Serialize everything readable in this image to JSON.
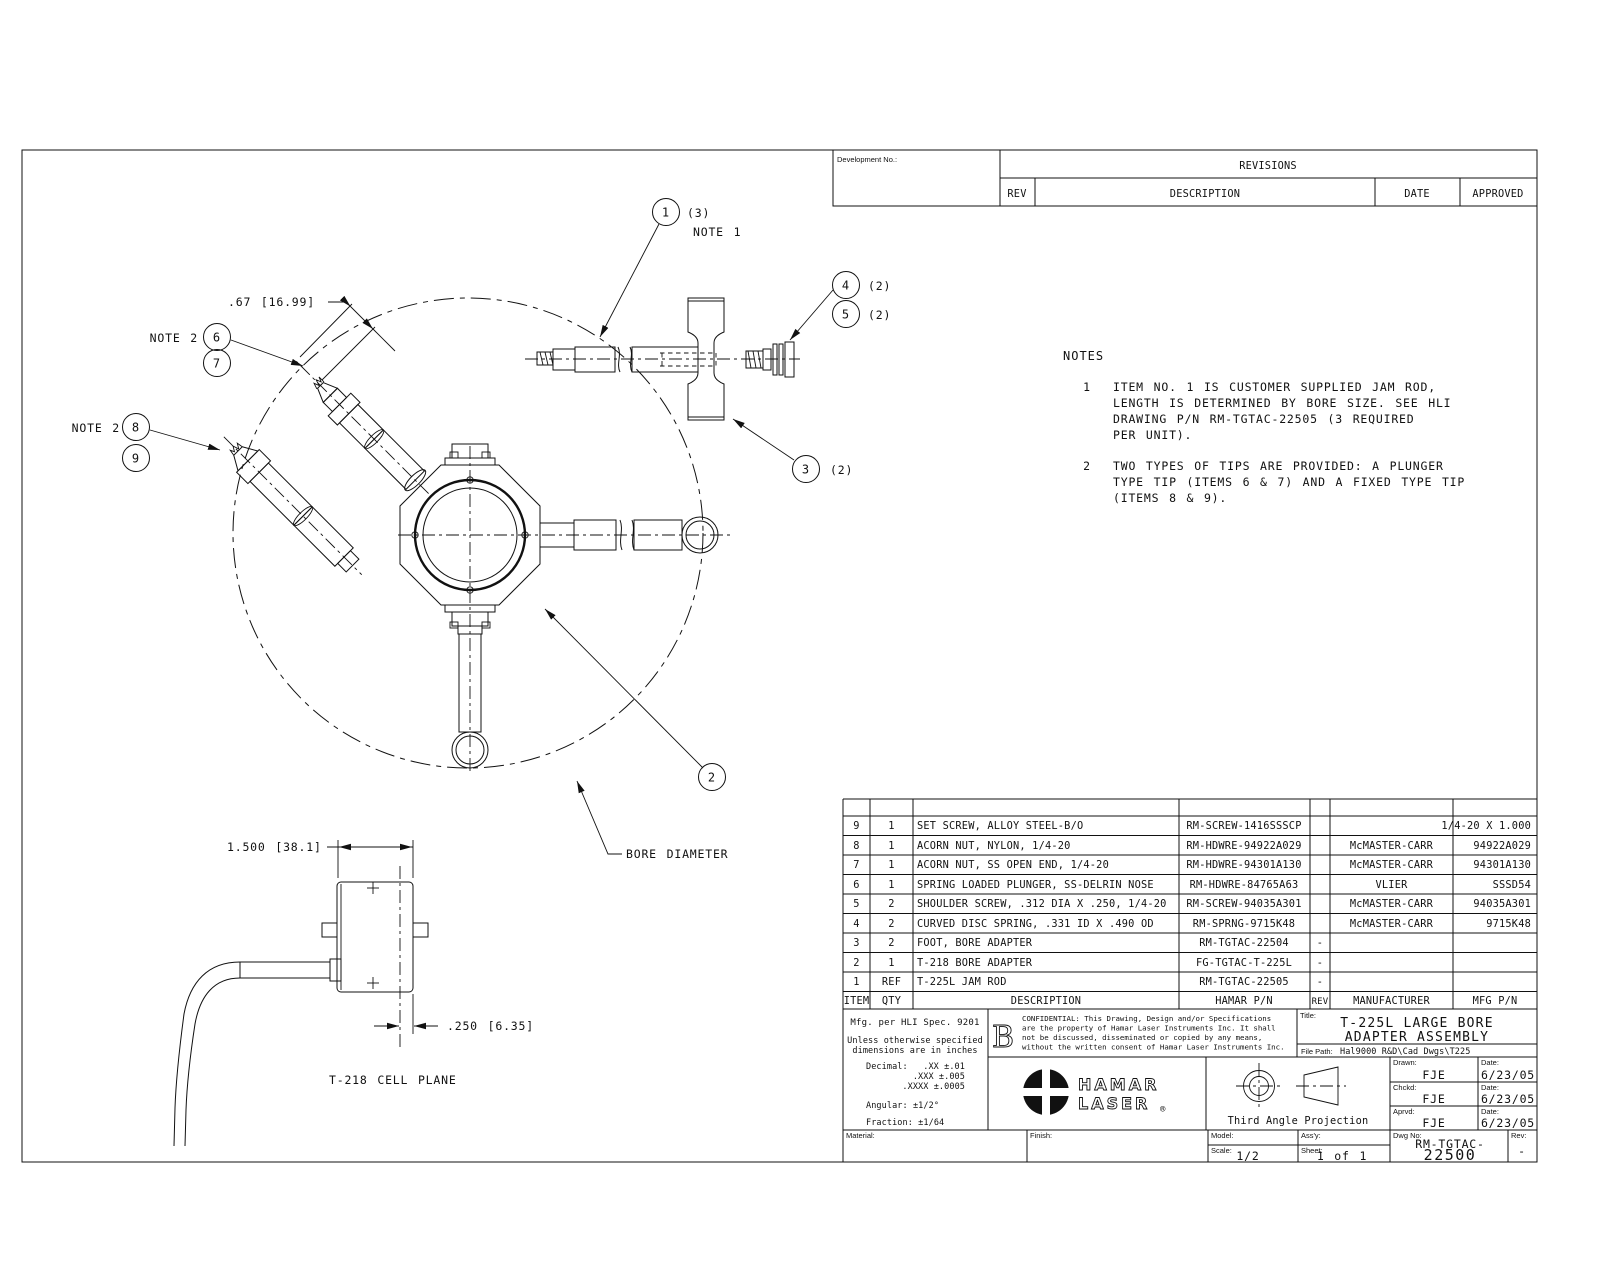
{
  "revisions": {
    "development_label": "Development No.:",
    "title": "REVISIONS",
    "col_rev": "REV",
    "col_description": "DESCRIPTION",
    "col_date": "DATE",
    "col_approved": "APPROVED"
  },
  "notes": {
    "title": "NOTES",
    "note1_num": "1",
    "note1_line1": "ITEM NO. 1 IS CUSTOMER SUPPLIED JAM ROD,",
    "note1_line2": "LENGTH IS DETERMINED BY BORE SIZE. SEE HLI",
    "note1_line3": "DRAWING P/N RM-TGTAC-22505 (3 REQUIRED",
    "note1_line4": "PER UNIT).",
    "note2_num": "2",
    "note2_line1": "TWO TYPES OF TIPS ARE PROVIDED: A PLUNGER",
    "note2_line2": "TYPE TIP (ITEMS 6 & 7) AND A FIXED TYPE TIP",
    "note2_line3": "(ITEMS 8 & 9)."
  },
  "callouts": {
    "b1": "1",
    "b1_qty": "(3)",
    "b1_note": "NOTE 1",
    "b2": "2",
    "b3": "3",
    "b3_qty": "(2)",
    "b4": "4",
    "b4_qty": "(2)",
    "b5": "5",
    "b5_qty": "(2)",
    "b6": "6",
    "b7": "7",
    "note2_ref_a": "NOTE 2",
    "b8": "8",
    "b9": "9",
    "note2_ref_b": "NOTE 2",
    "dim_tip": ".67 [16.99]",
    "bore_diameter": "BORE DIAMETER",
    "dim_width": "1.500 [38.1]",
    "dim_offset": ".250 [6.35]",
    "cell_plane": "T-218 CELL PLANE"
  },
  "bom": {
    "header": {
      "item": "ITEM",
      "qty": "QTY",
      "description": "DESCRIPTION",
      "hamar_pn": "HAMAR P/N",
      "rev": "REV",
      "manufacturer": "MANUFACTURER",
      "mfg_pn": "MFG P/N"
    },
    "rows": [
      {
        "item": "9",
        "qty": "1",
        "description": "SET SCREW, ALLOY STEEL-B/O",
        "hamar_pn": "RM-SCREW-1416SSSCP",
        "rev": "",
        "manufacturer": "",
        "mfg_pn": "1/4-20 X 1.000"
      },
      {
        "item": "8",
        "qty": "1",
        "description": "ACORN NUT, NYLON, 1/4-20",
        "hamar_pn": "RM-HDWRE-94922A029",
        "rev": "",
        "manufacturer": "McMASTER-CARR",
        "mfg_pn": "94922A029"
      },
      {
        "item": "7",
        "qty": "1",
        "description": "ACORN NUT, SS OPEN END, 1/4-20",
        "hamar_pn": "RM-HDWRE-94301A130",
        "rev": "",
        "manufacturer": "McMASTER-CARR",
        "mfg_pn": "94301A130"
      },
      {
        "item": "6",
        "qty": "1",
        "description": "SPRING LOADED PLUNGER, SS-DELRIN NOSE",
        "hamar_pn": "RM-HDWRE-84765A63",
        "rev": "",
        "manufacturer": "VLIER",
        "mfg_pn": "SSSD54"
      },
      {
        "item": "5",
        "qty": "2",
        "description": "SHOULDER SCREW, .312 DIA X .250, 1/4-20",
        "hamar_pn": "RM-SCREW-94035A301",
        "rev": "",
        "manufacturer": "McMASTER-CARR",
        "mfg_pn": "94035A301"
      },
      {
        "item": "4",
        "qty": "2",
        "description": "CURVED DISC SPRING, .331 ID X .490 OD",
        "hamar_pn": "RM-SPRNG-9715K48",
        "rev": "",
        "manufacturer": "McMASTER-CARR",
        "mfg_pn": "9715K48"
      },
      {
        "item": "3",
        "qty": "2",
        "description": "FOOT, BORE ADAPTER",
        "hamar_pn": "RM-TGTAC-22504",
        "rev": "-",
        "manufacturer": "",
        "mfg_pn": ""
      },
      {
        "item": "2",
        "qty": "1",
        "description": "T-218 BORE ADAPTER",
        "hamar_pn": "FG-TGTAC-T-225L",
        "rev": "-",
        "manufacturer": "",
        "mfg_pn": ""
      },
      {
        "item": "1",
        "qty": "REF",
        "description": "T-225L JAM ROD",
        "hamar_pn": "RM-TGTAC-22505",
        "rev": "-",
        "manufacturer": "",
        "mfg_pn": ""
      }
    ]
  },
  "title_block": {
    "mfg_spec": "Mfg. per HLI Spec. 9201",
    "tol_line1": "Unless otherwise specified",
    "tol_line2": "dimensions are in inches",
    "decimal_label": "Decimal:",
    "decimal_xx": ".XX ±.01",
    "decimal_xxx": ".XXX ±.005",
    "decimal_xxxx": ".XXXX ±.0005",
    "angular": "Angular: ±1/2°",
    "fraction": "Fraction: ±1/64",
    "stamp": "B",
    "conf_line1": "CONFIDENTIAL:  This Drawing, Design and/or Specifications",
    "conf_line2": "are the property of Hamar Laser Instruments Inc.  It shall",
    "conf_line3": "not be discussed, disseminated or copied by any means,",
    "conf_line4": "without the written consent of Hamar Laser Instruments Inc.",
    "logo_line1": "HAMAR",
    "logo_line2": "LASER",
    "registered": "®",
    "projection_label": "Third Angle Projection",
    "title_label": "Title:",
    "title_line1": "T-225L LARGE BORE",
    "title_line2": "ADAPTER ASSEMBLY",
    "file_path_label": "File Path:",
    "file_path": "Hal9000 R&D\\Cad Dwgs\\T225",
    "drawn_label": "Drawn:",
    "drawn": "FJE",
    "date_label1": "Date:",
    "drawn_date": "6/23/05",
    "chckd_label": "Chckd:",
    "chckd": "FJE",
    "date_label2": "Date:",
    "chckd_date": "6/23/05",
    "aprvd_label": "Aprvd:",
    "aprvd": "FJE",
    "date_label3": "Date:",
    "aprvd_date": "6/23/05",
    "material_label": "Material:",
    "finish_label": "Finish:",
    "model_label": "Model:",
    "assy_label": "Ass'y:",
    "scale_label": "Scale:",
    "scale": "1/2",
    "sheet_label": "Sheet:",
    "sheet": "1 of 1",
    "dwg_no_label": "Dwg No:",
    "dwg_no_line1": "RM-TGTAC-",
    "dwg_no_line2": "22500",
    "rev_label": "Rev:",
    "rev_value": "-"
  }
}
